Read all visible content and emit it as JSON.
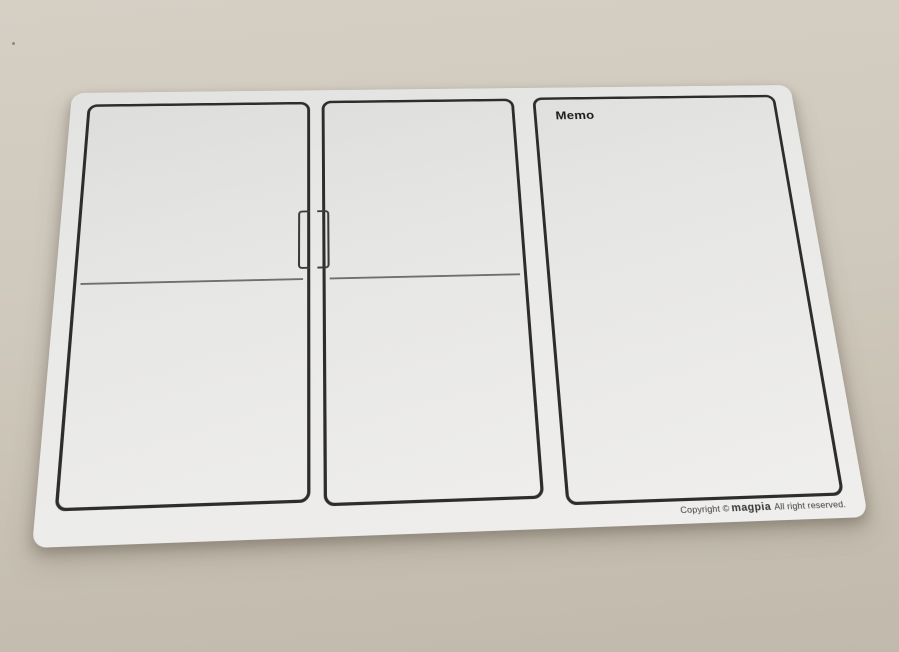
{
  "board": {
    "memo_label": "Memo",
    "copyright_prefix": "Copyright ©",
    "copyright_brand": "magpia",
    "copyright_suffix": "All right reserved.",
    "panels": [
      {
        "name": "left",
        "has_divider": true
      },
      {
        "name": "middle",
        "has_divider": true
      },
      {
        "name": "memo",
        "has_divider": false
      }
    ]
  },
  "colors": {
    "surface_top": "#d5cfc4",
    "surface_bottom": "#c1b9ab",
    "board_surface": "#e9e9e7",
    "panel_outline": "#2d2d2d",
    "divider_line": "#6f6f6f",
    "memo_text": "#1c1c1c",
    "copyright_text": "#3d3d3d"
  }
}
